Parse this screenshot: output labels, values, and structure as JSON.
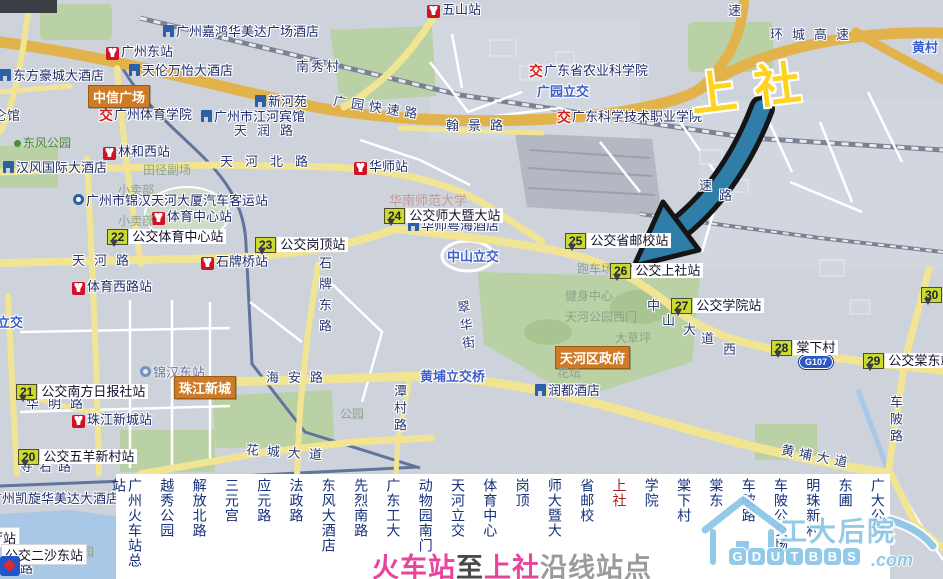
{
  "map": {
    "callout_text": "上社",
    "markers": [
      {
        "n": "20",
        "t": "公交五羊新村站",
        "x": 18,
        "y": 449
      },
      {
        "n": "21",
        "t": "公交南方日报社站",
        "x": 16,
        "y": 384
      },
      {
        "n": "22",
        "t": "公交体育中心站",
        "x": 107,
        "y": 229
      },
      {
        "n": "23",
        "t": "公交岗顶站",
        "x": 255,
        "y": 237
      },
      {
        "n": "24",
        "t": "公交师大暨大站",
        "x": 384,
        "y": 208
      },
      {
        "n": "25",
        "t": "公交省邮校站",
        "x": 565,
        "y": 233
      },
      {
        "n": "26",
        "t": "公交上社站",
        "x": 610,
        "y": 263
      },
      {
        "n": "27",
        "t": "公交学院站",
        "x": 671,
        "y": 298
      },
      {
        "n": "28",
        "t": "棠下村",
        "x": 771,
        "y": 340
      },
      {
        "n": "29",
        "t": "公交棠东站",
        "x": 863,
        "y": 353
      },
      {
        "n": "30",
        "t": "",
        "x": 921,
        "y": 287
      }
    ],
    "metro": [
      {
        "t": "广州东站",
        "x": 106,
        "y": 45
      },
      {
        "t": "五山站",
        "x": 427,
        "y": 3
      },
      {
        "t": "林和西站",
        "x": 103,
        "y": 145
      },
      {
        "t": "体育中心站",
        "x": 152,
        "y": 210
      },
      {
        "t": "华师站",
        "x": 354,
        "y": 160
      },
      {
        "t": "石牌桥站",
        "x": 201,
        "y": 255
      },
      {
        "t": "体育西路站",
        "x": 72,
        "y": 280
      },
      {
        "t": "珠江新城站",
        "x": 72,
        "y": 413
      }
    ],
    "hotels": [
      {
        "t": "广州嘉鸿华美达广场酒店",
        "x": 163,
        "y": 25
      },
      {
        "t": "东方豪城大酒店",
        "x": 0,
        "y": 69
      },
      {
        "t": "天伦万怡大酒店",
        "x": 129,
        "y": 64
      },
      {
        "t": "新河苑",
        "x": 255,
        "y": 95
      },
      {
        "t": "广州市江河宾馆",
        "x": 201,
        "y": 110
      },
      {
        "t": "汉风国际大酒店",
        "x": 3,
        "y": 161
      },
      {
        "t": "华师粤海酒店",
        "x": 408,
        "y": 219
      },
      {
        "t": "润都酒店",
        "x": 535,
        "y": 384
      },
      {
        "t": "广州凯旋华美达大酒店",
        "x": -24,
        "y": 492
      }
    ],
    "jiao": [
      {
        "t": "广州体育学院",
        "x": 99,
        "y": 108
      },
      {
        "t": "广东省农业科学院",
        "x": 529,
        "y": 64
      },
      {
        "t": "广东科学技术职业学院",
        "x": 557,
        "y": 110
      }
    ],
    "coach": [
      {
        "t": "广州市锦汉天河大厦汽车客运站",
        "x": 73,
        "y": 194,
        "faint": false
      },
      {
        "t": "锦汉东站",
        "x": 140,
        "y": 366,
        "faint": true
      }
    ],
    "areas": [
      {
        "t": "中信广场",
        "x": 88,
        "y": 85
      },
      {
        "t": "珠江新城",
        "x": 174,
        "y": 376
      },
      {
        "t": "天河区政府",
        "x": 555,
        "y": 346
      }
    ],
    "blue": [
      {
        "t": "广园立交",
        "x": 537,
        "y": 81
      },
      {
        "t": "中山立交",
        "x": 447,
        "y": 246
      },
      {
        "t": "黄埔立交桥",
        "x": 420,
        "y": 366
      },
      {
        "t": "路立交",
        "x": -16,
        "y": 312
      },
      {
        "t": "黄村",
        "x": 912,
        "y": 37
      }
    ],
    "roads": [
      {
        "t": "天润路",
        "x": 234,
        "y": 120,
        "ls": 10
      },
      {
        "t": "天河北路",
        "x": 220,
        "y": 151,
        "ls": 12
      },
      {
        "t": "天河路",
        "x": 72,
        "y": 250,
        "ls": 9
      },
      {
        "t": "广园快速路",
        "x": 333,
        "y": 97,
        "ls": 5,
        "rot": 9
      },
      {
        "t": "翰景路",
        "x": 446,
        "y": 115,
        "ls": 9
      },
      {
        "t": "环城高速",
        "x": 770,
        "y": 24,
        "ls": 9
      },
      {
        "t": "速",
        "x": 728,
        "y": 0
      },
      {
        "t": "速",
        "x": 699,
        "y": 175
      },
      {
        "t": "路",
        "x": 719,
        "y": 185
      },
      {
        "t": "石牌东路",
        "x": 315,
        "y": 256,
        "v": 1,
        "ls": 8
      },
      {
        "t": "翠华街",
        "x": 456,
        "y": 300,
        "v": 1,
        "ls": 5,
        "rot": -8
      },
      {
        "t": "海安路",
        "x": 266,
        "y": 367,
        "ls": 9
      },
      {
        "t": "华明路",
        "x": 26,
        "y": 393,
        "ls": 9
      },
      {
        "t": "潭村路",
        "x": 390,
        "y": 384,
        "v": 1,
        "ls": 4
      },
      {
        "t": "花城大道",
        "x": 246,
        "y": 442,
        "ls": 8,
        "rot": 4
      },
      {
        "t": "黄埔大道",
        "x": 781,
        "y": 446,
        "ls": 5,
        "rot": 11
      },
      {
        "t": "中山大道西",
        "x": 0,
        "y": 0,
        "chars": [
          [
            647,
            295
          ],
          [
            662,
            310
          ],
          [
            683,
            319
          ],
          [
            701,
            328
          ],
          [
            723,
            339
          ]
        ]
      },
      {
        "t": "车陂路",
        "x": 886,
        "y": 395,
        "v": 1,
        "ls": 4
      },
      {
        "t": "寺右路",
        "x": 20,
        "y": 456,
        "ls": 6
      },
      {
        "t": "南秀村",
        "x": 296,
        "y": 56,
        "ls": 2
      },
      {
        "t": "仑馆",
        "x": -6,
        "y": 105
      },
      {
        "t": "路",
        "x": 20,
        "y": 558
      }
    ],
    "faint": [
      {
        "t": "田径副场",
        "x": 143,
        "y": 161
      },
      {
        "t": "小卖部",
        "x": 118,
        "y": 181
      },
      {
        "t": "小卖部",
        "x": 118,
        "y": 212
      },
      {
        "t": "跑车场",
        "x": 577,
        "y": 260
      },
      {
        "t": "健身中心",
        "x": 565,
        "y": 287
      },
      {
        "t": "天河公园西门",
        "x": 565,
        "y": 308
      },
      {
        "t": "大草坪",
        "x": 615,
        "y": 329
      },
      {
        "t": "花坛",
        "x": 557,
        "y": 364
      },
      {
        "t": "园",
        "x": 82,
        "y": 543
      },
      {
        "t": "公园",
        "x": 340,
        "y": 405
      },
      {
        "t": "东风公园",
        "x": 14,
        "y": 134,
        "park": 1
      }
    ],
    "pink": [
      {
        "t": "华南师范大学",
        "x": 389,
        "y": 190
      }
    ],
    "white_tags": [
      {
        "t": "厅站",
        "x": -14,
        "y": 527
      },
      {
        "t": "公交二沙东站",
        "x": 1,
        "y": 544
      }
    ],
    "shield": {
      "t": "G107",
      "x": 799,
      "y": 355
    }
  },
  "strip": {
    "stations": [
      "广州火车站总站",
      "越秀公园",
      "解放北路",
      "三元宫",
      "应元路",
      "法政路",
      "东风大酒店",
      "先烈南路",
      "广东工大",
      "动物园南门",
      "天河立交",
      "体育中心",
      "岗顶",
      "师大暨大",
      "省邮校",
      "上社",
      "学院",
      "棠下村",
      "棠东",
      "车陂路",
      "车陂公交场",
      "明珠新村",
      "东圃",
      "广大公司"
    ],
    "highlight": "上社",
    "highlight_color": "#ab1a1a",
    "text_color": "#16307c"
  },
  "caption": {
    "segments": [
      {
        "t": "火车站",
        "c": "#e8439d"
      },
      {
        "t": "至",
        "c": "#4a4a4a"
      },
      {
        "t": "上社",
        "c": "#e8439d"
      },
      {
        "t": "沿线站点",
        "c": "#9b9b9b"
      }
    ]
  },
  "logo": {
    "cn": "工大后院",
    "tiles": [
      "G",
      "D",
      "U",
      "T",
      "B",
      "B",
      "S"
    ],
    "suffix": ".com",
    "color": "#8cc6e8"
  },
  "colors": {
    "marker_box": "#ccda2e",
    "callout_yellow": "#ffd41e",
    "road_yellow": "#f1e593",
    "highway_orange": "#e2b24b",
    "park_green": "#b9d1a4",
    "water_blue": "#a9c7e6",
    "metro_red": "#cf1225"
  }
}
